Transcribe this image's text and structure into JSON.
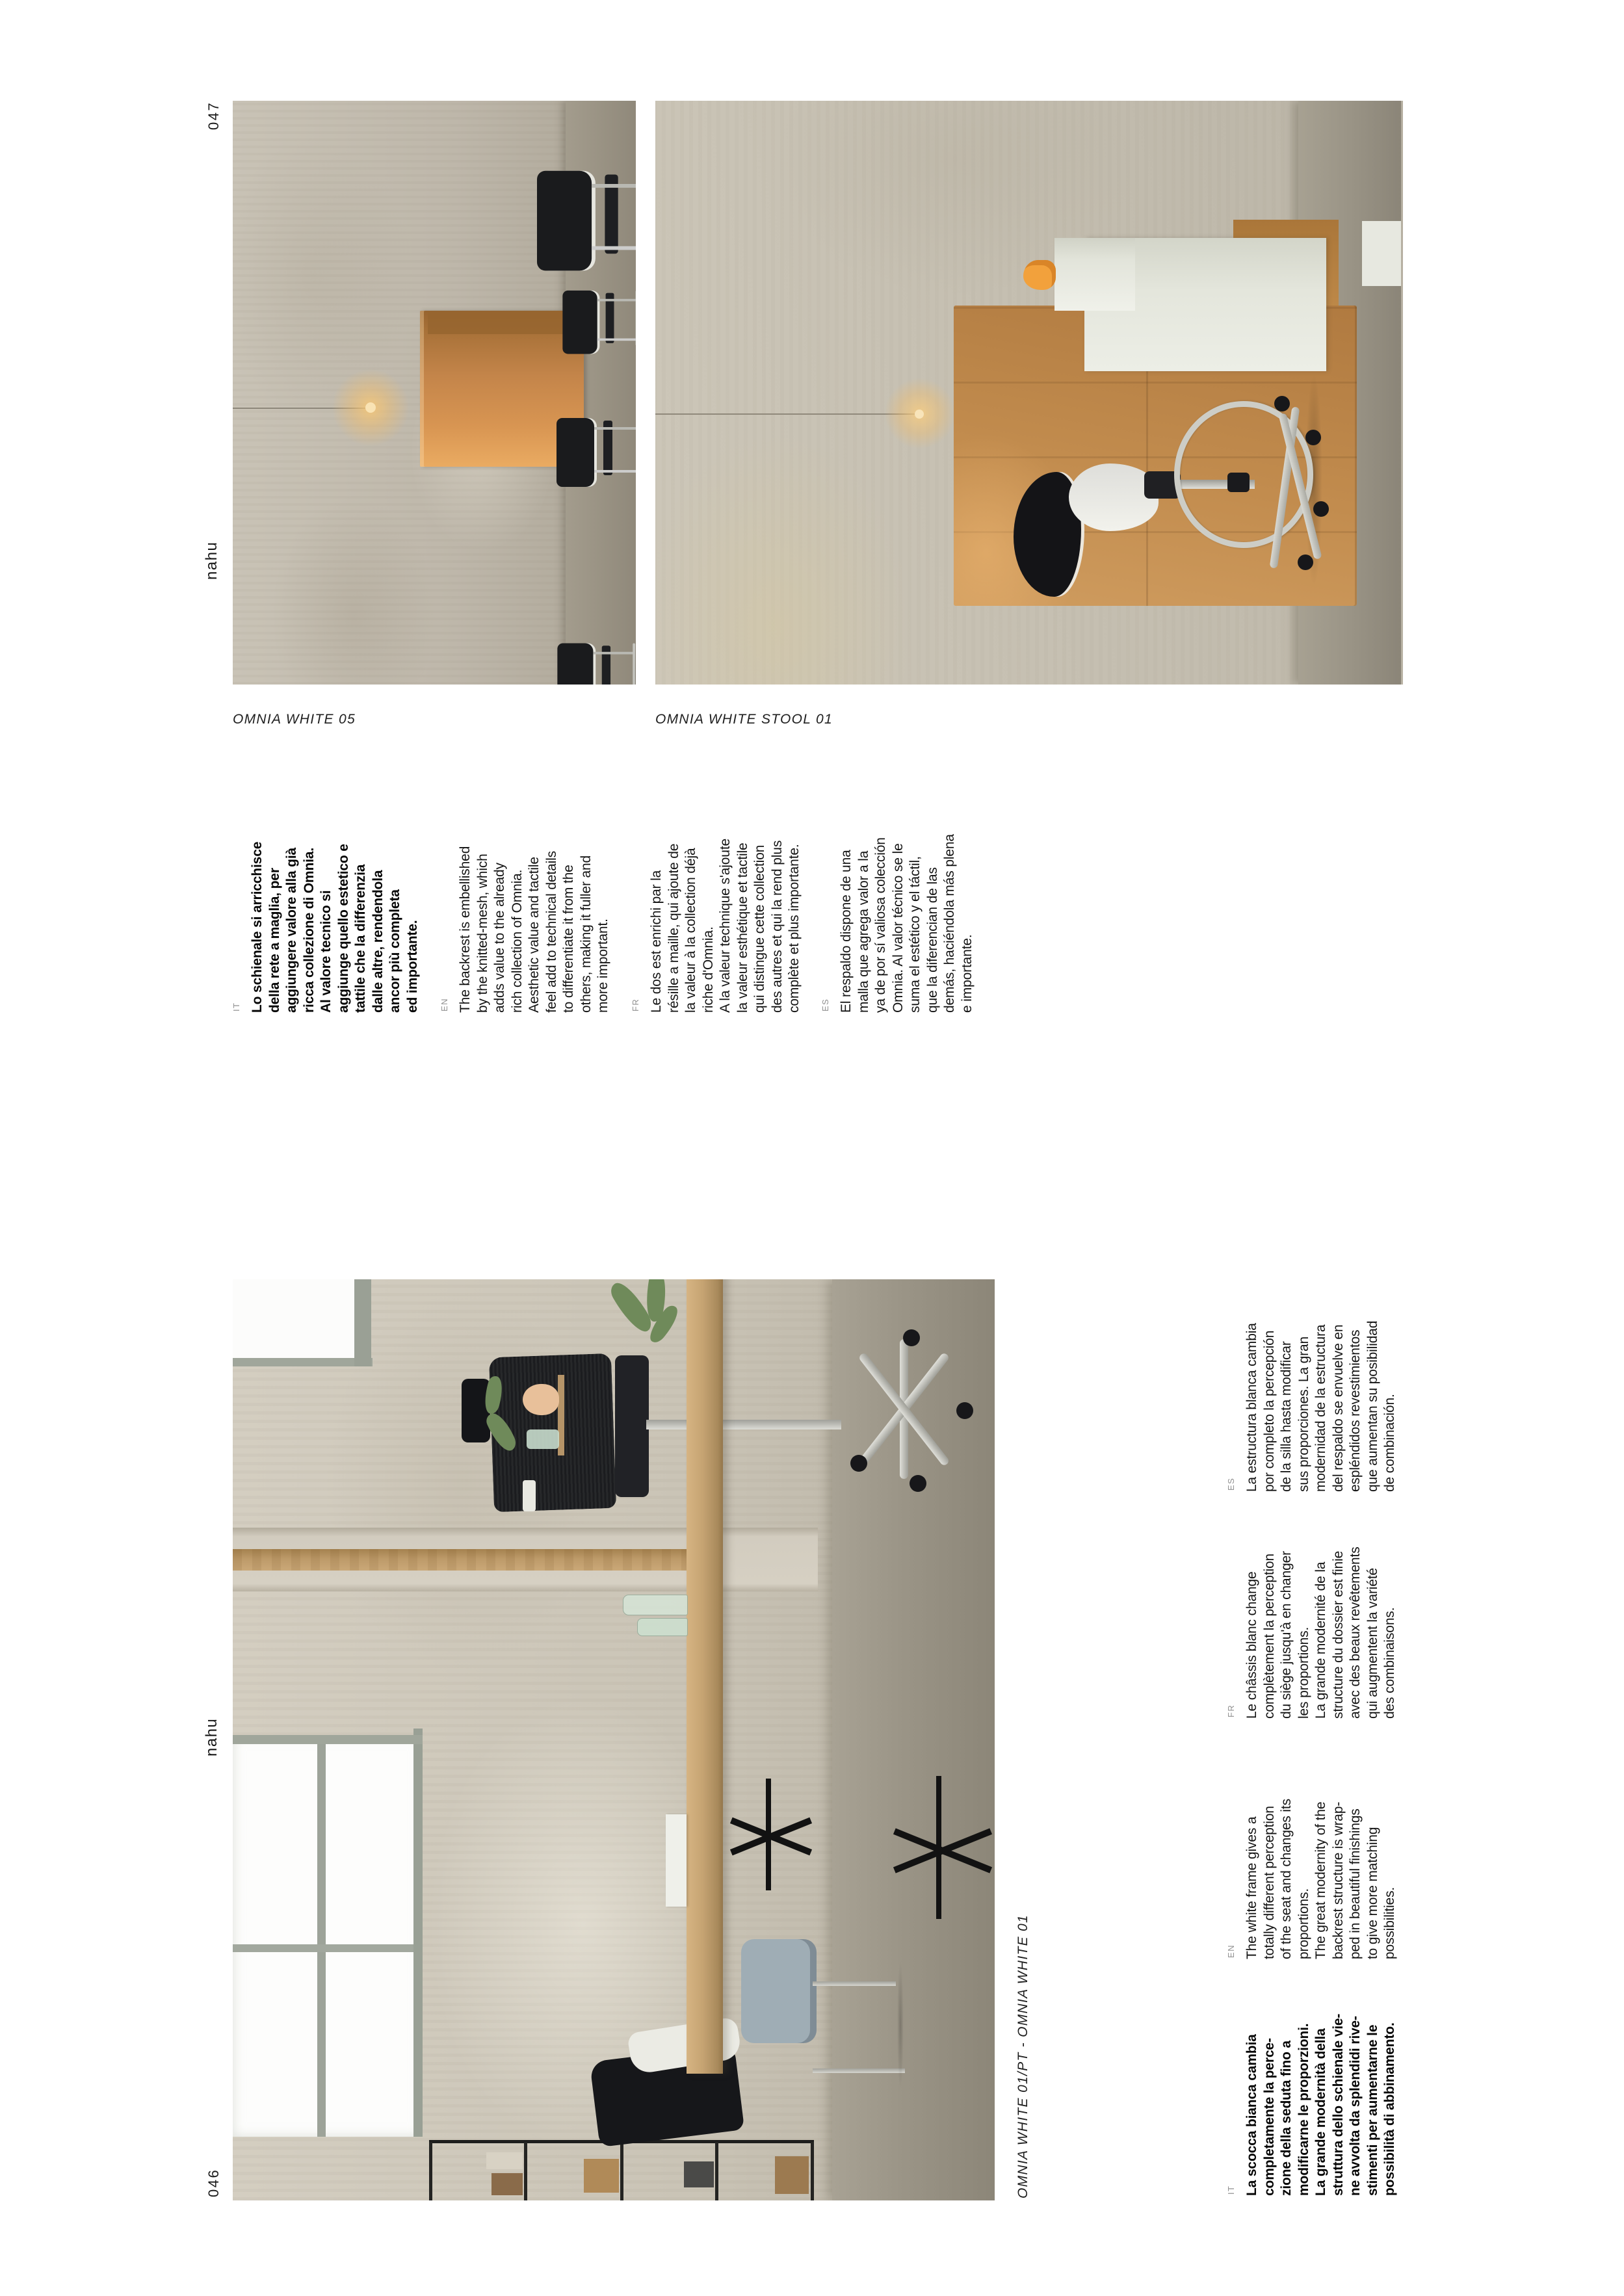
{
  "page": {
    "left_page_number": "046",
    "right_page_number": "047",
    "brand": "nahu"
  },
  "colors": {
    "text": "#141414",
    "bold_text": "#060606",
    "language_label": "#8f8f8f",
    "caption": "#1f1f1f",
    "concrete_wall": "#c4beb0",
    "concrete_floor": "#9a9486",
    "cardboard_tan": "#c28c4e",
    "booth_tan": "#c4854a",
    "wood_desk": "#c5a372",
    "accent_orange_bird": "#f2a13c",
    "lamp_glow": "#f0be6e",
    "chair_black": "#1a1b1d",
    "chair_white": "#ececе6"
  },
  "top_section": {
    "photo1_caption": "OMNIA WHITE 05",
    "photo2_caption": "OMNIA WHITE STOOL 01",
    "blocks": [
      {
        "lang": "IT",
        "bold": true,
        "lines": [
          "Lo schienale si arricchisce",
          "della rete a maglia, per",
          "aggiungere valore alla già",
          "ricca collezione di Omnia.",
          "Al valore tecnico si",
          "aggiunge quello estetico e",
          "tattile che la differenzia",
          "dalle altre, rendendola",
          "ancor più completa",
          "ed importante."
        ]
      },
      {
        "lang": "EN",
        "bold": false,
        "lines": [
          "The backrest is embellished",
          "by the knitted-mesh, which",
          "adds value to the already",
          "rich collection of Omnia.",
          "Aesthetic value and tactile",
          "feel add to technical details",
          "to differentiate it from the",
          "others, making it fuller and",
          "more important."
        ]
      },
      {
        "lang": "FR",
        "bold": false,
        "lines": [
          "Le dos est enrichi par la",
          "résille a maille, qui ajoute de",
          "la valeur à la collection déjà",
          "riche d'Omnia.",
          "A la valeur technique s'ajoute",
          "la valeur esthétique et tactile",
          "qui distingue cette collection",
          "des autres et qui la rend plus",
          "complète et plus importante."
        ]
      },
      {
        "lang": "ES",
        "bold": false,
        "lines": [
          "El respaldo dispone de una",
          "malla que agrega valor a la",
          "ya de por sí valiosa colección",
          "Omnia. Al valor técnico se le",
          "suma el estético y el táctil,",
          "que la diferencian de las",
          "demás, haciéndola más plena",
          "e importante."
        ]
      }
    ]
  },
  "bottom_section": {
    "photo_caption": "OMNIA WHITE 01/PT - OMNIA WHITE 01",
    "blocks": [
      {
        "lang": "IT",
        "bold": true,
        "lines": [
          "La scocca bianca cambia",
          "completamente la perce-",
          "zione della seduta fino a",
          "modificarne le proporzioni.",
          "La grande modernità della",
          "struttura dello schienale vie-",
          "ne avvolta da splendidi rive-",
          "stimenti per aumentarne le",
          "possibilità di abbinamento."
        ]
      },
      {
        "lang": "EN",
        "bold": false,
        "lines": [
          "The white frame gives a",
          "totally different perception",
          "of the seat and changes its",
          "proportions.",
          "The great modernity of the",
          "backrest structure is wrap-",
          "ped in beautiful finishings",
          "to give more matching",
          "possibilities."
        ]
      },
      {
        "lang": "FR",
        "bold": false,
        "lines": [
          "Le châssis blanc change",
          "complètement la perception",
          "du siège jusqu'à en changer",
          "les proportions.",
          "La grande modernité de la",
          "structure du dossier est finie",
          "avec des beaux revêtements",
          "qui augmentent la variété",
          "des combinaisons."
        ]
      },
      {
        "lang": "ES",
        "bold": false,
        "lines": [
          "La estructura blanca cambia",
          "por completo la percepción",
          "de la silla hasta modificar",
          "sus proporciones. La gran",
          "modernidad de la estructura",
          "del respaldo se envuelve en",
          "espléndidos revestimientos",
          "que aumentan su posibilidad",
          "de combinación."
        ]
      }
    ]
  }
}
